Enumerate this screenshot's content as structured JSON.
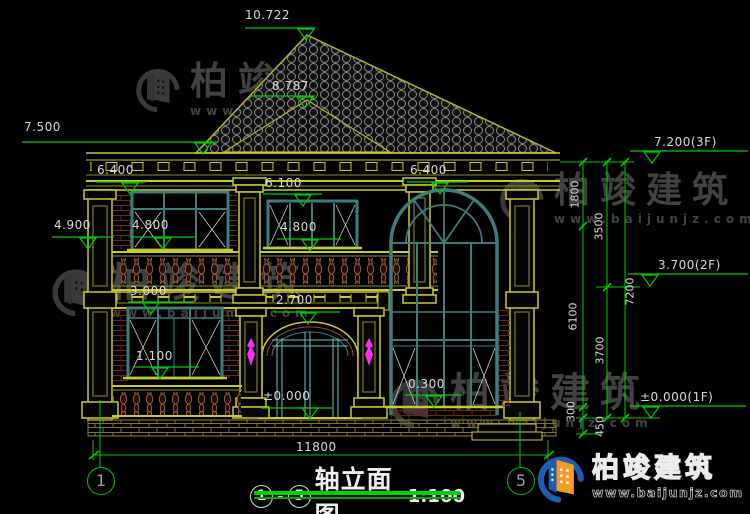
{
  "title_block": {
    "axis_start": "1",
    "dash": "-",
    "axis_end": "5",
    "name": "轴立面图",
    "scale": "1:100"
  },
  "axes": {
    "left": "1",
    "right": "5"
  },
  "elevations": {
    "ridge": "10.722",
    "lower_ridge": "8.787",
    "eave_left": "7.500",
    "left_window_top": "6.400",
    "center_window_top": "6.100",
    "arch_top": "6.400",
    "balcony_rail": "4.900",
    "left_sill": "4.800",
    "center_sill": "4.800",
    "slab": "3.000",
    "door_top": "2.700",
    "sill_1f": "1.100",
    "ground": "±0.000",
    "arch_sill": "0.300",
    "floor3": "7.200(3F)",
    "floor2": "3.700(2F)",
    "floor1": "±0.000(1F)"
  },
  "dimensions": {
    "total_width": "11800",
    "d1800": "1800",
    "d3500": "3500",
    "d6100": "6100",
    "d3700": "3700",
    "d7200": "7200",
    "d300": "300",
    "d450": "450"
  },
  "watermark": {
    "brand": "柏竣建筑",
    "url": "www.baijunjz.com"
  },
  "logo": {
    "brand": "柏竣建筑",
    "url": "www.baijunjz.com"
  },
  "colors": {
    "cad_yellow": "#c9c92e",
    "dim_green": "#00cd00",
    "window_teal": "#3f7d7b",
    "brick_red": "#6e2620",
    "baluster_brown": "#9a5a40",
    "ornament_magenta": "#ff2bff",
    "text_gray": "#d9d9d9",
    "logo_blue": "#1a5fb4",
    "logo_orange": "#f59a23"
  }
}
